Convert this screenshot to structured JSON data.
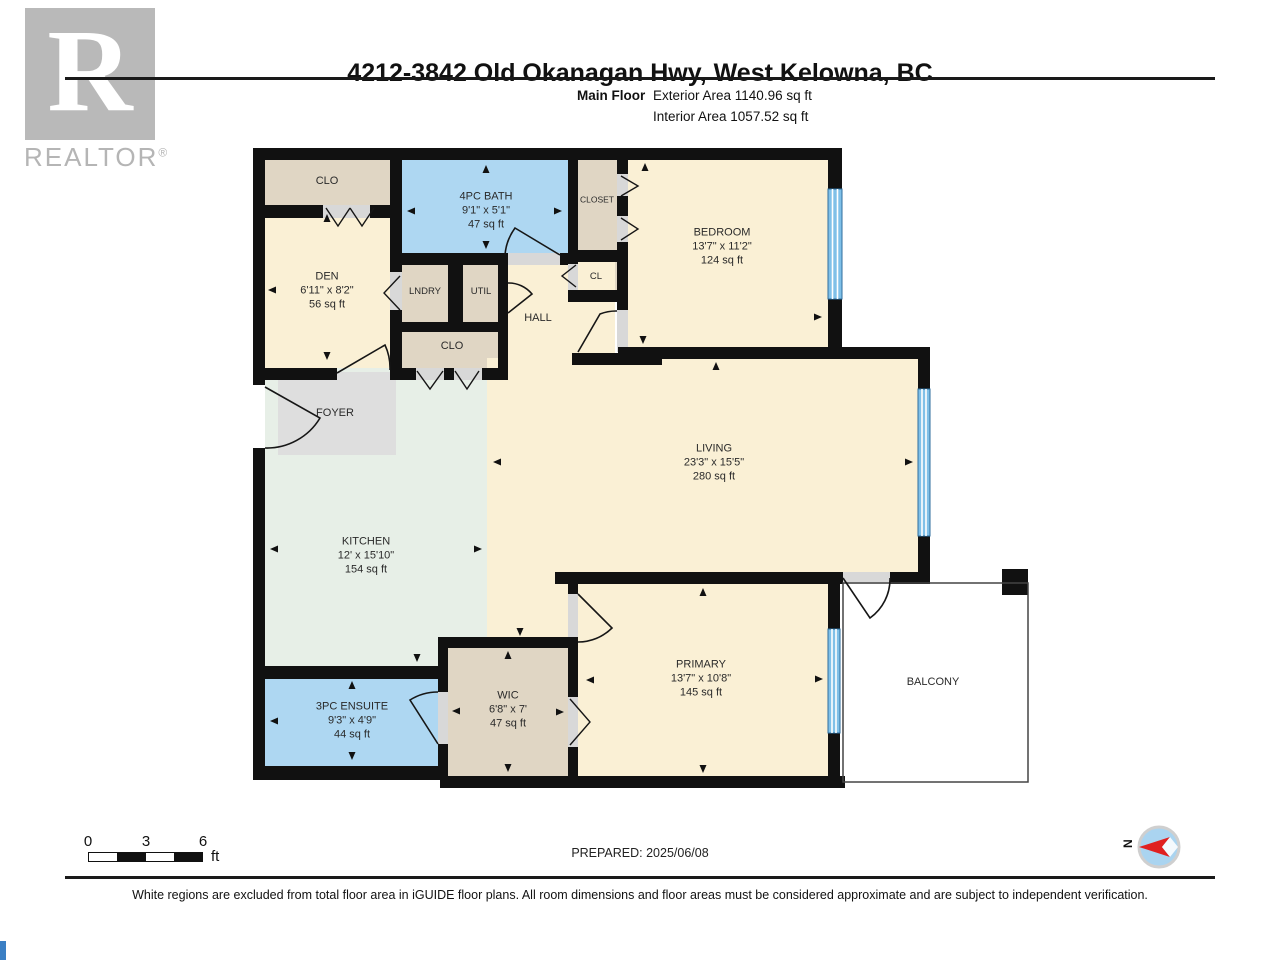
{
  "header": {
    "title": "4212-3842 Old Okanagan Hwy, West Kelowna, BC",
    "floor_label": "Main Floor",
    "exterior_area": "Exterior Area 1140.96 sq ft",
    "interior_area": "Interior Area 1057.52 sq ft"
  },
  "branding": {
    "logo_letter": "R",
    "wordmark": "REALTOR",
    "registered": "®"
  },
  "rooms": {
    "clo1": {
      "name": "CLO"
    },
    "den": {
      "name": "DEN",
      "dims": "6'11\" x 8'2\"",
      "area": "56 sq ft"
    },
    "bath": {
      "name": "4PC BATH",
      "dims": "9'1\" x 5'1\"",
      "area": "47 sq ft"
    },
    "closet": {
      "name": "CLOSET"
    },
    "bedroom": {
      "name": "BEDROOM",
      "dims": "13'7\" x 11'2\"",
      "area": "124 sq ft"
    },
    "lndry": {
      "name": "LNDRY"
    },
    "util": {
      "name": "UTIL"
    },
    "cl": {
      "name": "CL"
    },
    "hall": {
      "name": "HALL"
    },
    "clo2": {
      "name": "CLO"
    },
    "foyer": {
      "name": "FOYER"
    },
    "kitchen": {
      "name": "KITCHEN",
      "dims": "12' x 15'10\"",
      "area": "154 sq ft"
    },
    "living": {
      "name": "LIVING",
      "dims": "23'3\" x 15'5\"",
      "area": "280 sq ft"
    },
    "ensuite": {
      "name": "3PC ENSUITE",
      "dims": "9'3\" x 4'9\"",
      "area": "44 sq ft"
    },
    "wic": {
      "name": "WIC",
      "dims": "6'8\" x 7'",
      "area": "47 sq ft"
    },
    "primary": {
      "name": "PRIMARY",
      "dims": "13'7\" x 10'8\"",
      "area": "145 sq ft"
    },
    "balcony": {
      "name": "BALCONY"
    }
  },
  "scale_bar": {
    "tick_0": "0",
    "tick_3": "3",
    "tick_6": "6",
    "unit": "ft"
  },
  "compass": {
    "north": "N"
  },
  "footer": {
    "prepared": "PREPARED: 2025/06/08",
    "disclaimer": "White regions are excluded from total floor area in iGUIDE floor plans. All room dimensions and floor areas must be considered approximate and are subject to independent verification."
  },
  "colors": {
    "wall": "#111111",
    "room_cream": "#faf0d5",
    "room_beige": "#e0d6c4",
    "room_blue": "#aed7f2",
    "room_mint": "#e7efe7",
    "room_gray": "#dedede",
    "window_blue": "#7fc0e8",
    "window_frame": "#2f6e9e",
    "compass_fill": "#aad4f0",
    "compass_needle": "#e02020",
    "logo_gray": "#b9b9b9"
  }
}
